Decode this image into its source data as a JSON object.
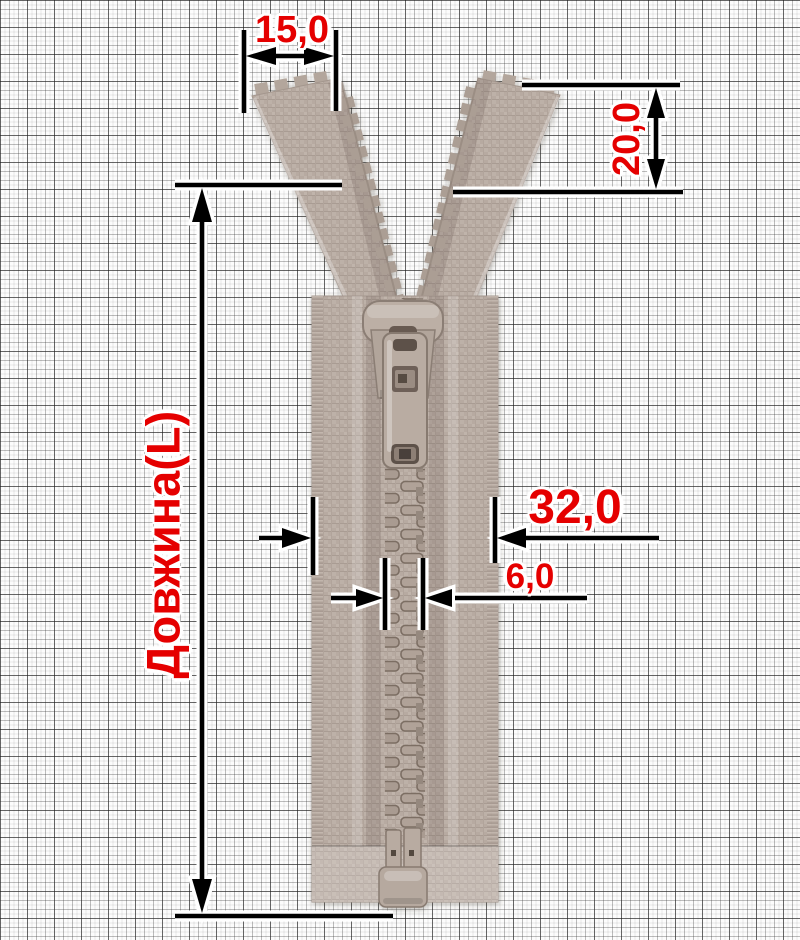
{
  "figure_name": "open-end-molded-plastic-zipper",
  "labels": {
    "top_tape_width": "15,0",
    "open_top_height": "20,0",
    "length": "Довжина(L)",
    "tape_width": "32,0",
    "teeth_width": "6,0"
  },
  "colors": {
    "dimension_text": "#e50000",
    "dimension_line": "#000000",
    "dimension_halo": "#ffffff",
    "zipper_tape": "#b7aaa1",
    "zipper_teeth_shadow": "#7c6e64",
    "paper_background": "#fcfcfc"
  }
}
